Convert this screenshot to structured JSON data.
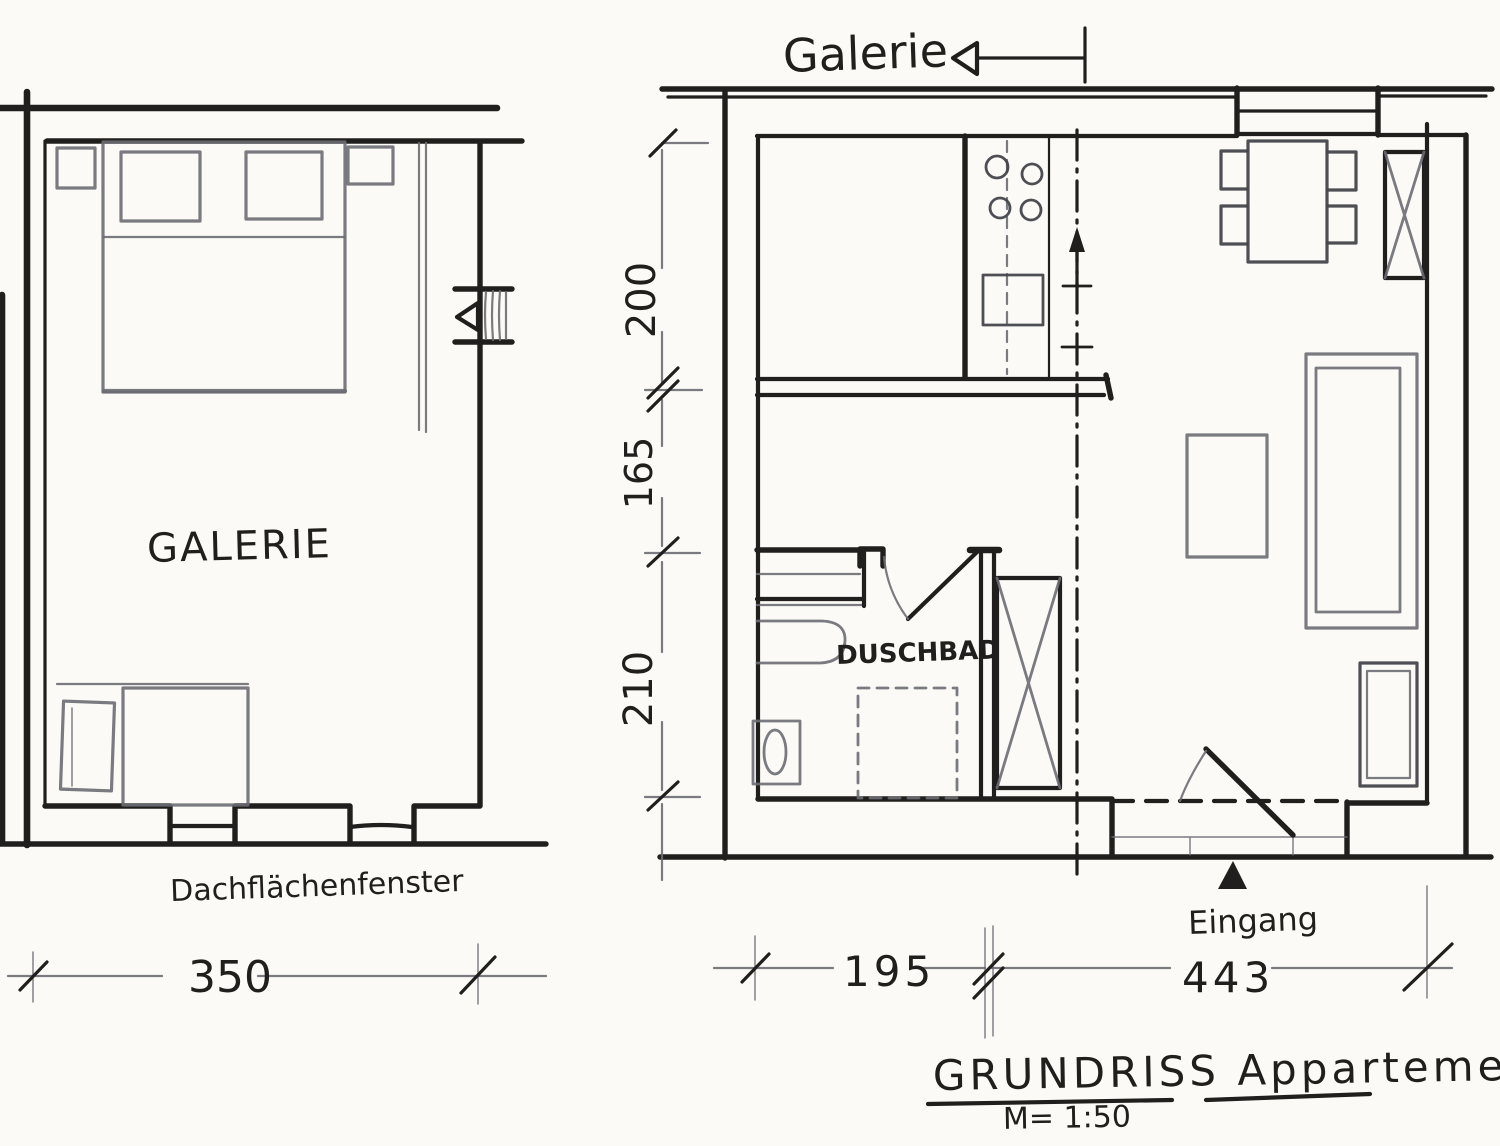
{
  "colors": {
    "ink": "#201f1d",
    "pencil": "#6b6b74",
    "pencil2": "#45444c",
    "paper": "#fbfaf6"
  },
  "document": {
    "title": "GRUNDRISS Appartement",
    "scale": "M= 1:50"
  },
  "left_plan": {
    "room_label": "GALERIE",
    "window_label": "Dachflächenfenster",
    "width_dim": "350"
  },
  "right_plan": {
    "gallery_label": "Galerie",
    "bath_label": "DUSCHBAD",
    "entrance_label": "Eingang",
    "vertical_dims": [
      "200",
      "165",
      "210"
    ],
    "horizontal_dims": [
      "195",
      "443"
    ]
  }
}
